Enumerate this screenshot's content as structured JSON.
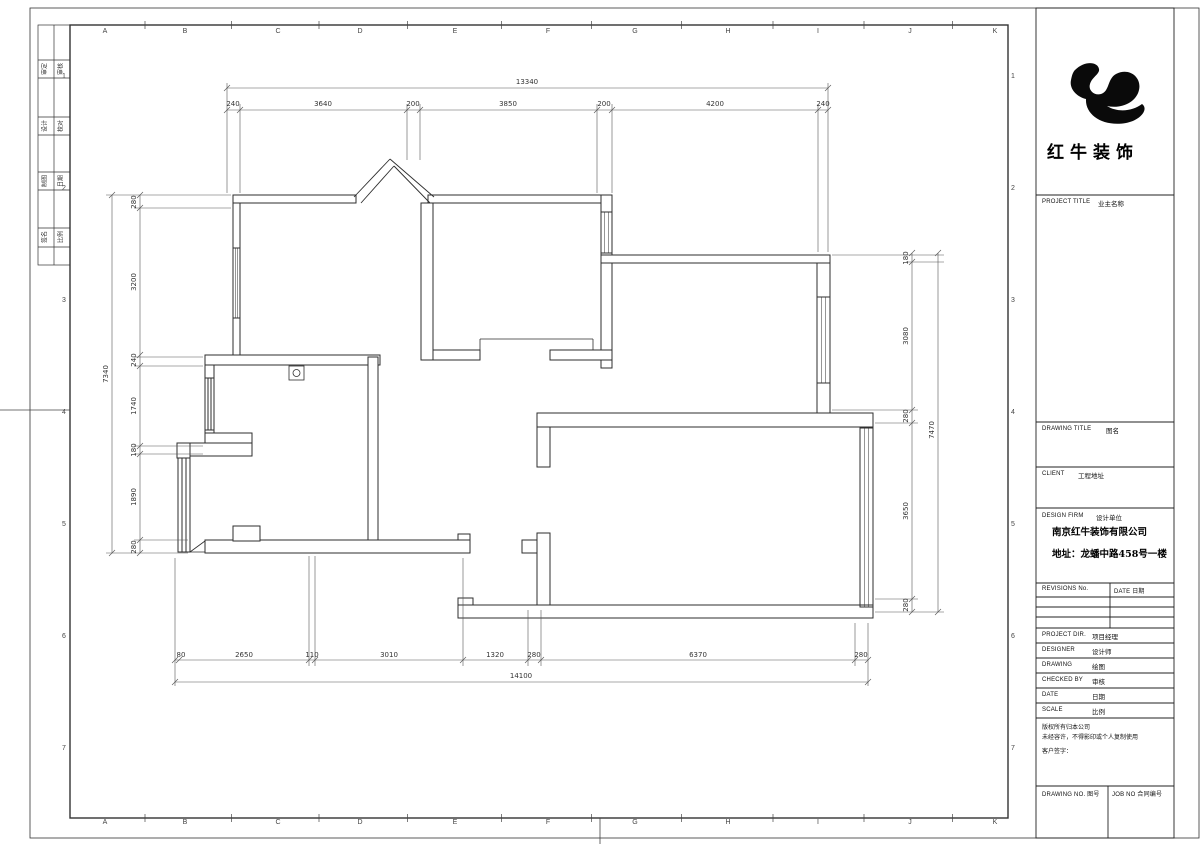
{
  "sheet": {
    "grid_letters": [
      "A",
      "B",
      "C",
      "D",
      "E",
      "F",
      "G",
      "H",
      "I",
      "J",
      "K"
    ],
    "grid_letter_x": [
      105,
      185,
      278,
      360,
      455,
      548,
      635,
      728,
      818,
      910,
      995
    ],
    "row_numbers": [
      "1",
      "2",
      "3",
      "4",
      "5",
      "6",
      "7"
    ],
    "row_number_y": [
      78,
      190,
      302,
      414,
      526,
      638,
      750
    ],
    "strip_rows": [
      [
        "审定",
        "审核"
      ],
      [
        "设计",
        "校对"
      ],
      [
        "制图",
        "日期"
      ],
      [
        "签名",
        "比例"
      ]
    ]
  },
  "plan": {
    "dim_labels": [
      {
        "t": "240",
        "x": 233,
        "y": 106
      },
      {
        "t": "3640",
        "x": 323,
        "y": 106
      },
      {
        "t": "200",
        "x": 413,
        "y": 106
      },
      {
        "t": "3850",
        "x": 508,
        "y": 106
      },
      {
        "t": "200",
        "x": 604,
        "y": 106
      },
      {
        "t": "4200",
        "x": 715,
        "y": 106
      },
      {
        "t": "240",
        "x": 823,
        "y": 106
      },
      {
        "t": "13340",
        "x": 527,
        "y": 84
      },
      {
        "t": "80",
        "x": 181,
        "y": 657
      },
      {
        "t": "2650",
        "x": 244,
        "y": 657
      },
      {
        "t": "110",
        "x": 312,
        "y": 657
      },
      {
        "t": "3010",
        "x": 389,
        "y": 657
      },
      {
        "t": "1320",
        "x": 495,
        "y": 657
      },
      {
        "t": "280",
        "x": 534,
        "y": 657
      },
      {
        "t": "6370",
        "x": 698,
        "y": 657
      },
      {
        "t": "280",
        "x": 861,
        "y": 657
      },
      {
        "t": "14100",
        "x": 521,
        "y": 678
      },
      {
        "t": "280",
        "x": 136,
        "y": 202,
        "r": -90
      },
      {
        "t": "3200",
        "x": 136,
        "y": 282,
        "r": -90
      },
      {
        "t": "240",
        "x": 136,
        "y": 360,
        "r": -90
      },
      {
        "t": "1740",
        "x": 136,
        "y": 406,
        "r": -90
      },
      {
        "t": "180",
        "x": 136,
        "y": 450,
        "r": -90
      },
      {
        "t": "1890",
        "x": 136,
        "y": 497,
        "r": -90
      },
      {
        "t": "280",
        "x": 136,
        "y": 547,
        "r": -90
      },
      {
        "t": "7340",
        "x": 108,
        "y": 374,
        "r": -90
      },
      {
        "t": "180",
        "x": 908,
        "y": 258,
        "r": -90
      },
      {
        "t": "3080",
        "x": 908,
        "y": 336,
        "r": -90
      },
      {
        "t": "280",
        "x": 908,
        "y": 416,
        "r": -90
      },
      {
        "t": "3650",
        "x": 908,
        "y": 511,
        "r": -90
      },
      {
        "t": "280",
        "x": 908,
        "y": 605,
        "r": -90
      },
      {
        "t": "7470",
        "x": 934,
        "y": 430,
        "r": -90
      }
    ]
  },
  "title_block": {
    "logo_text": "红牛装饰",
    "project_title_label": "PROJECT TITLE",
    "project_title_value": "业主名称",
    "drawing_title_label": "DRAWING TITLE",
    "drawing_title_value": "图名",
    "client_label": "CLIENT",
    "client_value": "工程地址",
    "design_firm_label": "DESIGN FIRM",
    "design_firm_value": "设计单位",
    "company_name": "南京红牛装饰有限公司",
    "company_address": "地址：龙蟠中路458号一楼",
    "revisions_label": "REVISIONS No.",
    "revisions_date_label": "DATE 日期",
    "rows": [
      {
        "label": "PROJECT DIR.",
        "value": "项目经理"
      },
      {
        "label": "DESIGNER",
        "value": "设计师"
      },
      {
        "label": "DRAWING",
        "value": "绘图"
      },
      {
        "label": "CHECKED BY",
        "value": "审核"
      },
      {
        "label": "DATE",
        "value": "日期"
      },
      {
        "label": "SCALE",
        "value": "比例"
      }
    ],
    "notes": [
      "版权所有归本公司",
      "未经容许，不得影印或个人复制使用",
      "客户签字："
    ],
    "drawing_no_label": "DRAWING NO. 图号",
    "job_no_label": "JOB NO 合同编号"
  }
}
